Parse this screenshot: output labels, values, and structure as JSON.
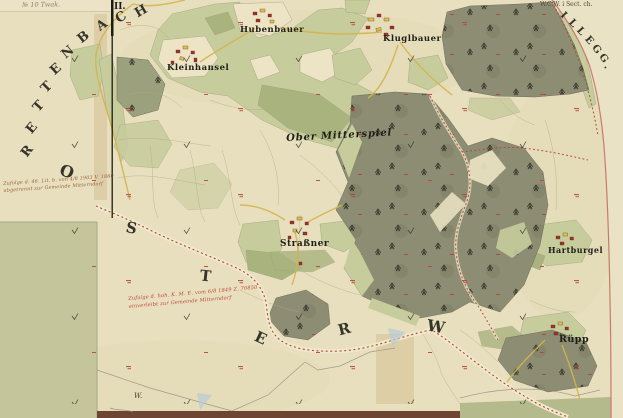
{
  "colors": {
    "paper": "#e8dfbe",
    "paper_margin": "#eae2c4",
    "field": "#ece4c4",
    "meadow": "#c7cc9c",
    "meadow_dark": "#a9b37e",
    "forest": "#8d8d73",
    "forest_light": "#9ba17d",
    "olive_block": "#c4c59b",
    "stain": "#cdb488",
    "boundary_red": "#b5453a",
    "edge_pink": "#c97a6e",
    "road_yellow": "#d4b44e",
    "building_red": "#a33327",
    "building_yellow": "#dfc04a",
    "ink": "#26261e",
    "pencil": "#8f8c7d",
    "band_brown": "#6e4433",
    "band_olive": "#b4ba8c",
    "water_blue": "#b9cbd4"
  },
  "words": {
    "rettenbach": "RETTENBACH",
    "osterw": "OSTERW",
    "illegg": "ILLEGG."
  },
  "marginalia": {
    "sheet_number": "II.",
    "corner_note": "W.C.W. i Sect. ch.",
    "margin_note": "№ 10 Twak.",
    "pencil_mark": "W."
  },
  "places": {
    "kleinhansel": "Kleinhansel",
    "hubenbauer": "Hubenbauer",
    "kluglbauer": "Kluglbauer",
    "region": "Ober Mitterspiel",
    "strassner": "Straßner",
    "hartburgel": "Hartburgel",
    "ruepp": "Rüpp"
  },
  "annotations": {
    "brown_line1": "Zufolge d. 46. Lit. b. von 4/8 1903 V. 1860",
    "brown_line2": "abgetrennt zur Gemeinde Mitterndorf",
    "red_line1": "Zufolge d. hoh. K. M. E. vom 6/8 1849 Z. 70850",
    "red_line2": "einverleibt zur Gemeinde Mitterndorf"
  }
}
